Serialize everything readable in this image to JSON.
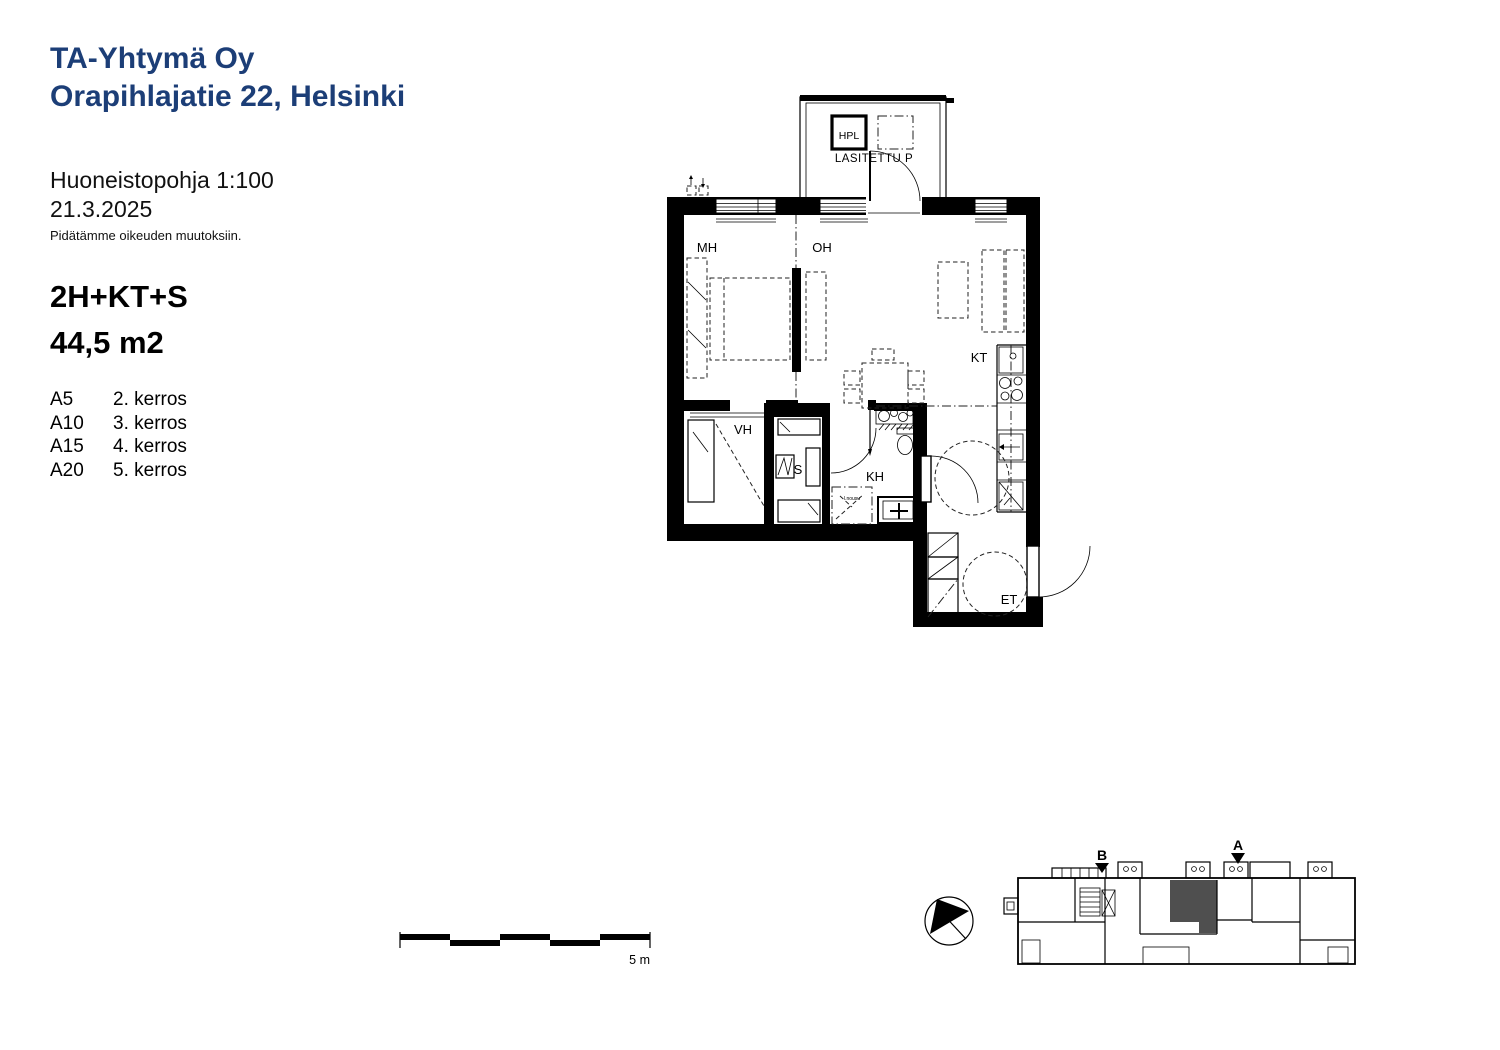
{
  "header": {
    "company": "TA-Yhtymä Oy",
    "address": "Orapihlajatie 22, Helsinki"
  },
  "meta": {
    "plan_title": "Huoneistopohja 1:100",
    "date": "21.3.2025",
    "disclaimer": "Pidätämme oikeuden muutoksiin."
  },
  "apartment": {
    "layout": "2H+KT+S",
    "area": "44,5 m2"
  },
  "units": [
    {
      "id": "A5",
      "floor": "2. kerros"
    },
    {
      "id": "A10",
      "floor": "3. kerros"
    },
    {
      "id": "A15",
      "floor": "4. kerros"
    },
    {
      "id": "A20",
      "floor": "5. kerros"
    }
  ],
  "plan": {
    "rooms": {
      "mh": "MH",
      "oh": "OH",
      "kt": "KT",
      "vh": "VH",
      "s": "S",
      "kh": "KH",
      "et": "ET"
    },
    "balcony": {
      "hpl": "HPL",
      "label": "LASITETTU P"
    },
    "riser_note": "l.nousu"
  },
  "scale_bar": {
    "label": "5 m"
  },
  "key_plan": {
    "stair_a": "A",
    "stair_b": "B"
  },
  "colors": {
    "brand_blue": "#1c3e77",
    "ink": "#000000",
    "highlight_gray": "#4f4f4f"
  }
}
